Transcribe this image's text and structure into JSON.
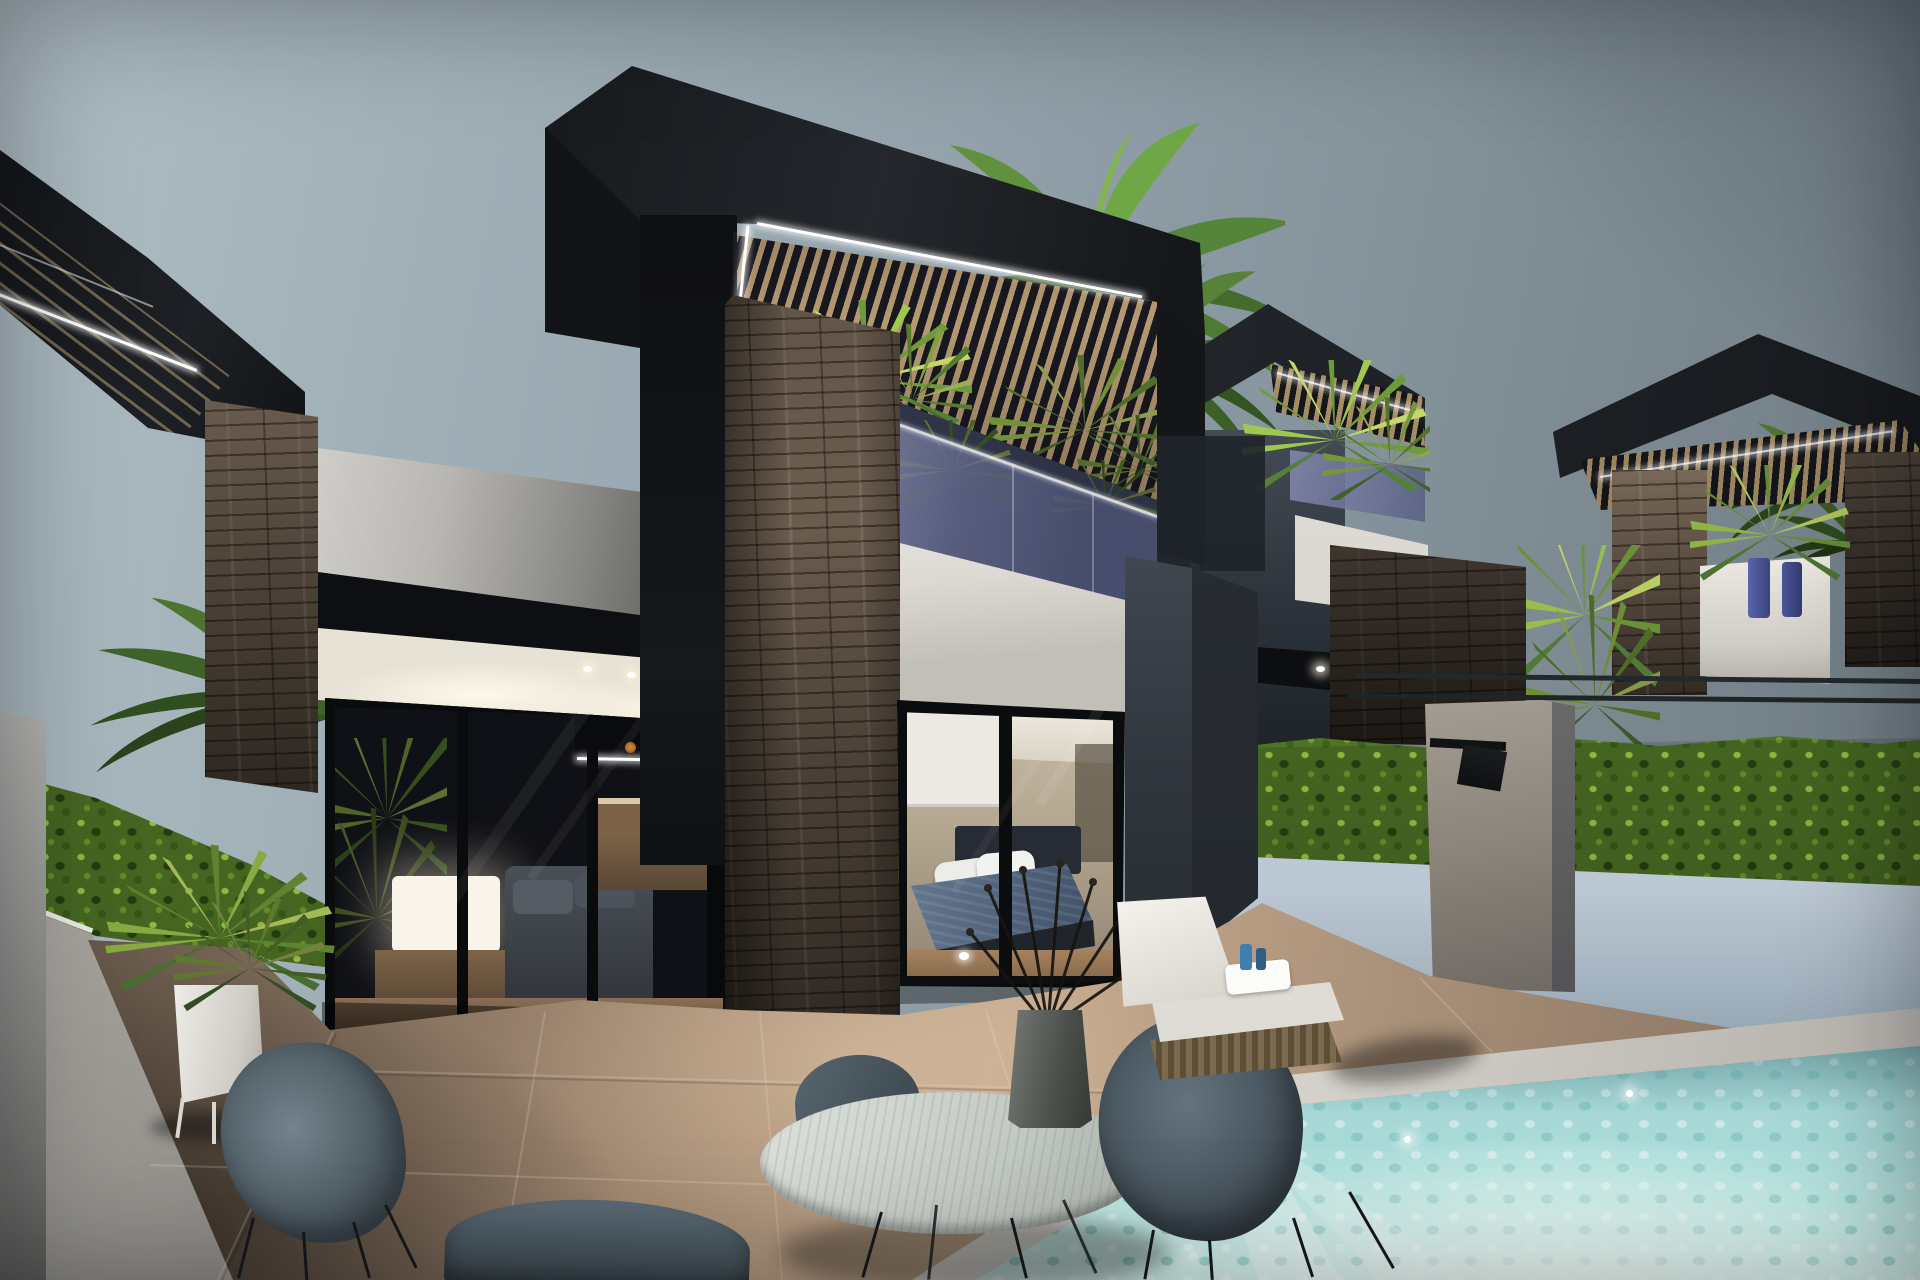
{
  "scene": {
    "type": "architectural-render",
    "time_of_day": "dusk",
    "elements": [
      "sky",
      "main-villa",
      "neighbor-villas",
      "black-box-roof",
      "wood-pergola-slats",
      "led-strip-lighting",
      "stacked-stone-column",
      "glass-balcony",
      "balcony-plants",
      "bedroom-sliding-door",
      "bed",
      "living-room",
      "table-lamp",
      "kitchen-island",
      "terrace-tiles",
      "swimming-pool",
      "pool-steps",
      "sun-lounger",
      "round-dining-table",
      "twig-vase",
      "shell-chairs",
      "ivy-hedge-walls",
      "outdoor-shower",
      "palm-trees",
      "white-planter"
    ]
  },
  "colors": {
    "sky_left": "#aebdc3",
    "sky_mid": "#93a2ab",
    "sky_right": "#6e7a82",
    "roof": "#1b1d21",
    "roof_dark": "#101114",
    "led": "#ffffff",
    "slat": "#b59a72",
    "slat_gap": "#191820",
    "stone_hi": "#8d7a68",
    "stone_mid": "#68594b",
    "stone_dark": "#3c332a",
    "white_wall": "#efece6",
    "parapet": "#d8d6d1",
    "fascia": "#0d0f12",
    "soffit": "#f4f0e7",
    "glass": "#8a90b6",
    "glass_deep": "#4e5476",
    "hedge": "#4f7326",
    "hedge_light": "#8fc043",
    "hedge_dark": "#2a3f14",
    "wall_blue": "#aebdc9",
    "shower": "#9b948a",
    "pillar": "#3a4149",
    "pillar_side": "#272c33",
    "floor_light": "#c3aa91",
    "floor_mid": "#a08a74",
    "floor_dark": "#574b40",
    "pool": "#a3d5d3",
    "pool_glow": "#ecfbf7",
    "coping": "#dcd9d2",
    "chair": "#5d6d78",
    "chair_dark": "#46525b",
    "leg": "#17181a",
    "table": "#cdd3cd",
    "lounger": "#ebe9e4",
    "wicker": "#76654b",
    "interior_warm": "#b5a28a",
    "bed": "#5c7089",
    "headboard": "#272b33",
    "pillow": "#ecece9",
    "lamp": "#f8f4e9",
    "blind": "#ece9e3",
    "planter": "#e7e5e0",
    "palm_light": "#84b450",
    "palm_mid": "#55853a",
    "palm_dark": "#345423",
    "trunk": "#6e5843"
  }
}
